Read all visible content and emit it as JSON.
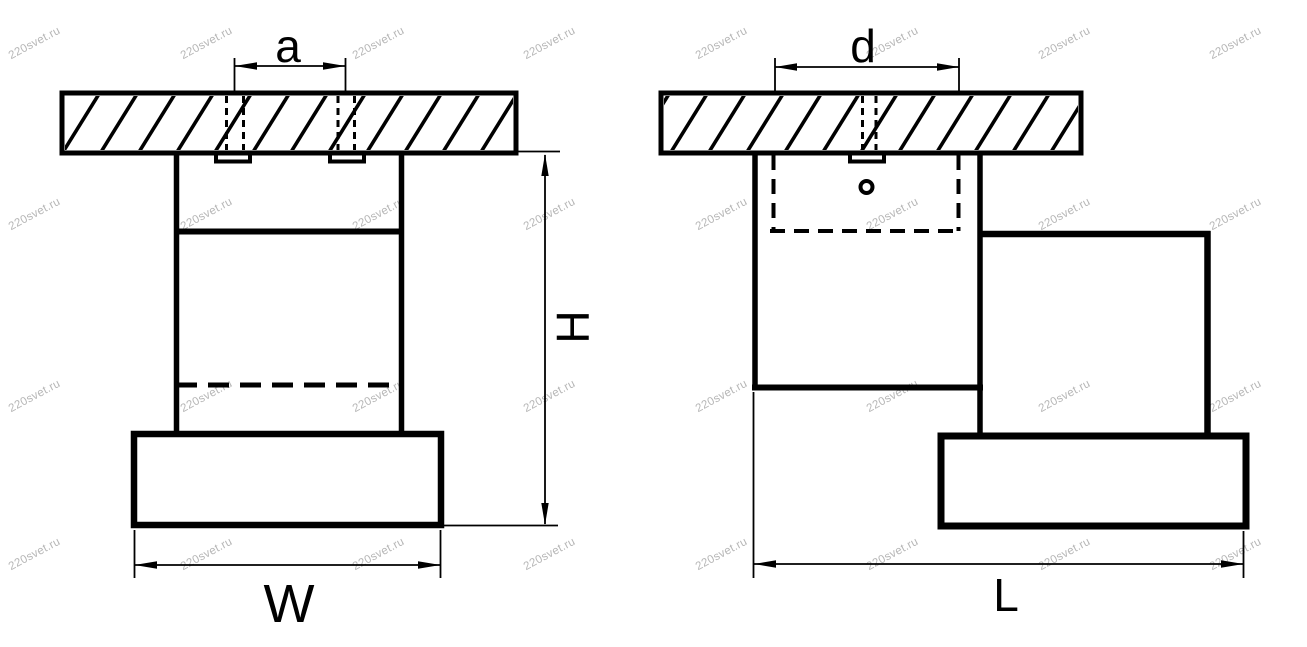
{
  "watermark": {
    "text": "220svet.ru",
    "color": "#b6b6b6"
  },
  "drawing": {
    "background": "#ffffff",
    "line_color": "#000000",
    "description": "Dimensional line drawing of a ceiling-mounted spotlight, front and side projections"
  },
  "views": {
    "front": {
      "labels": {
        "a": "a",
        "h": "H",
        "w": "W"
      }
    },
    "side": {
      "labels": {
        "d": "d",
        "l": "L"
      }
    }
  }
}
